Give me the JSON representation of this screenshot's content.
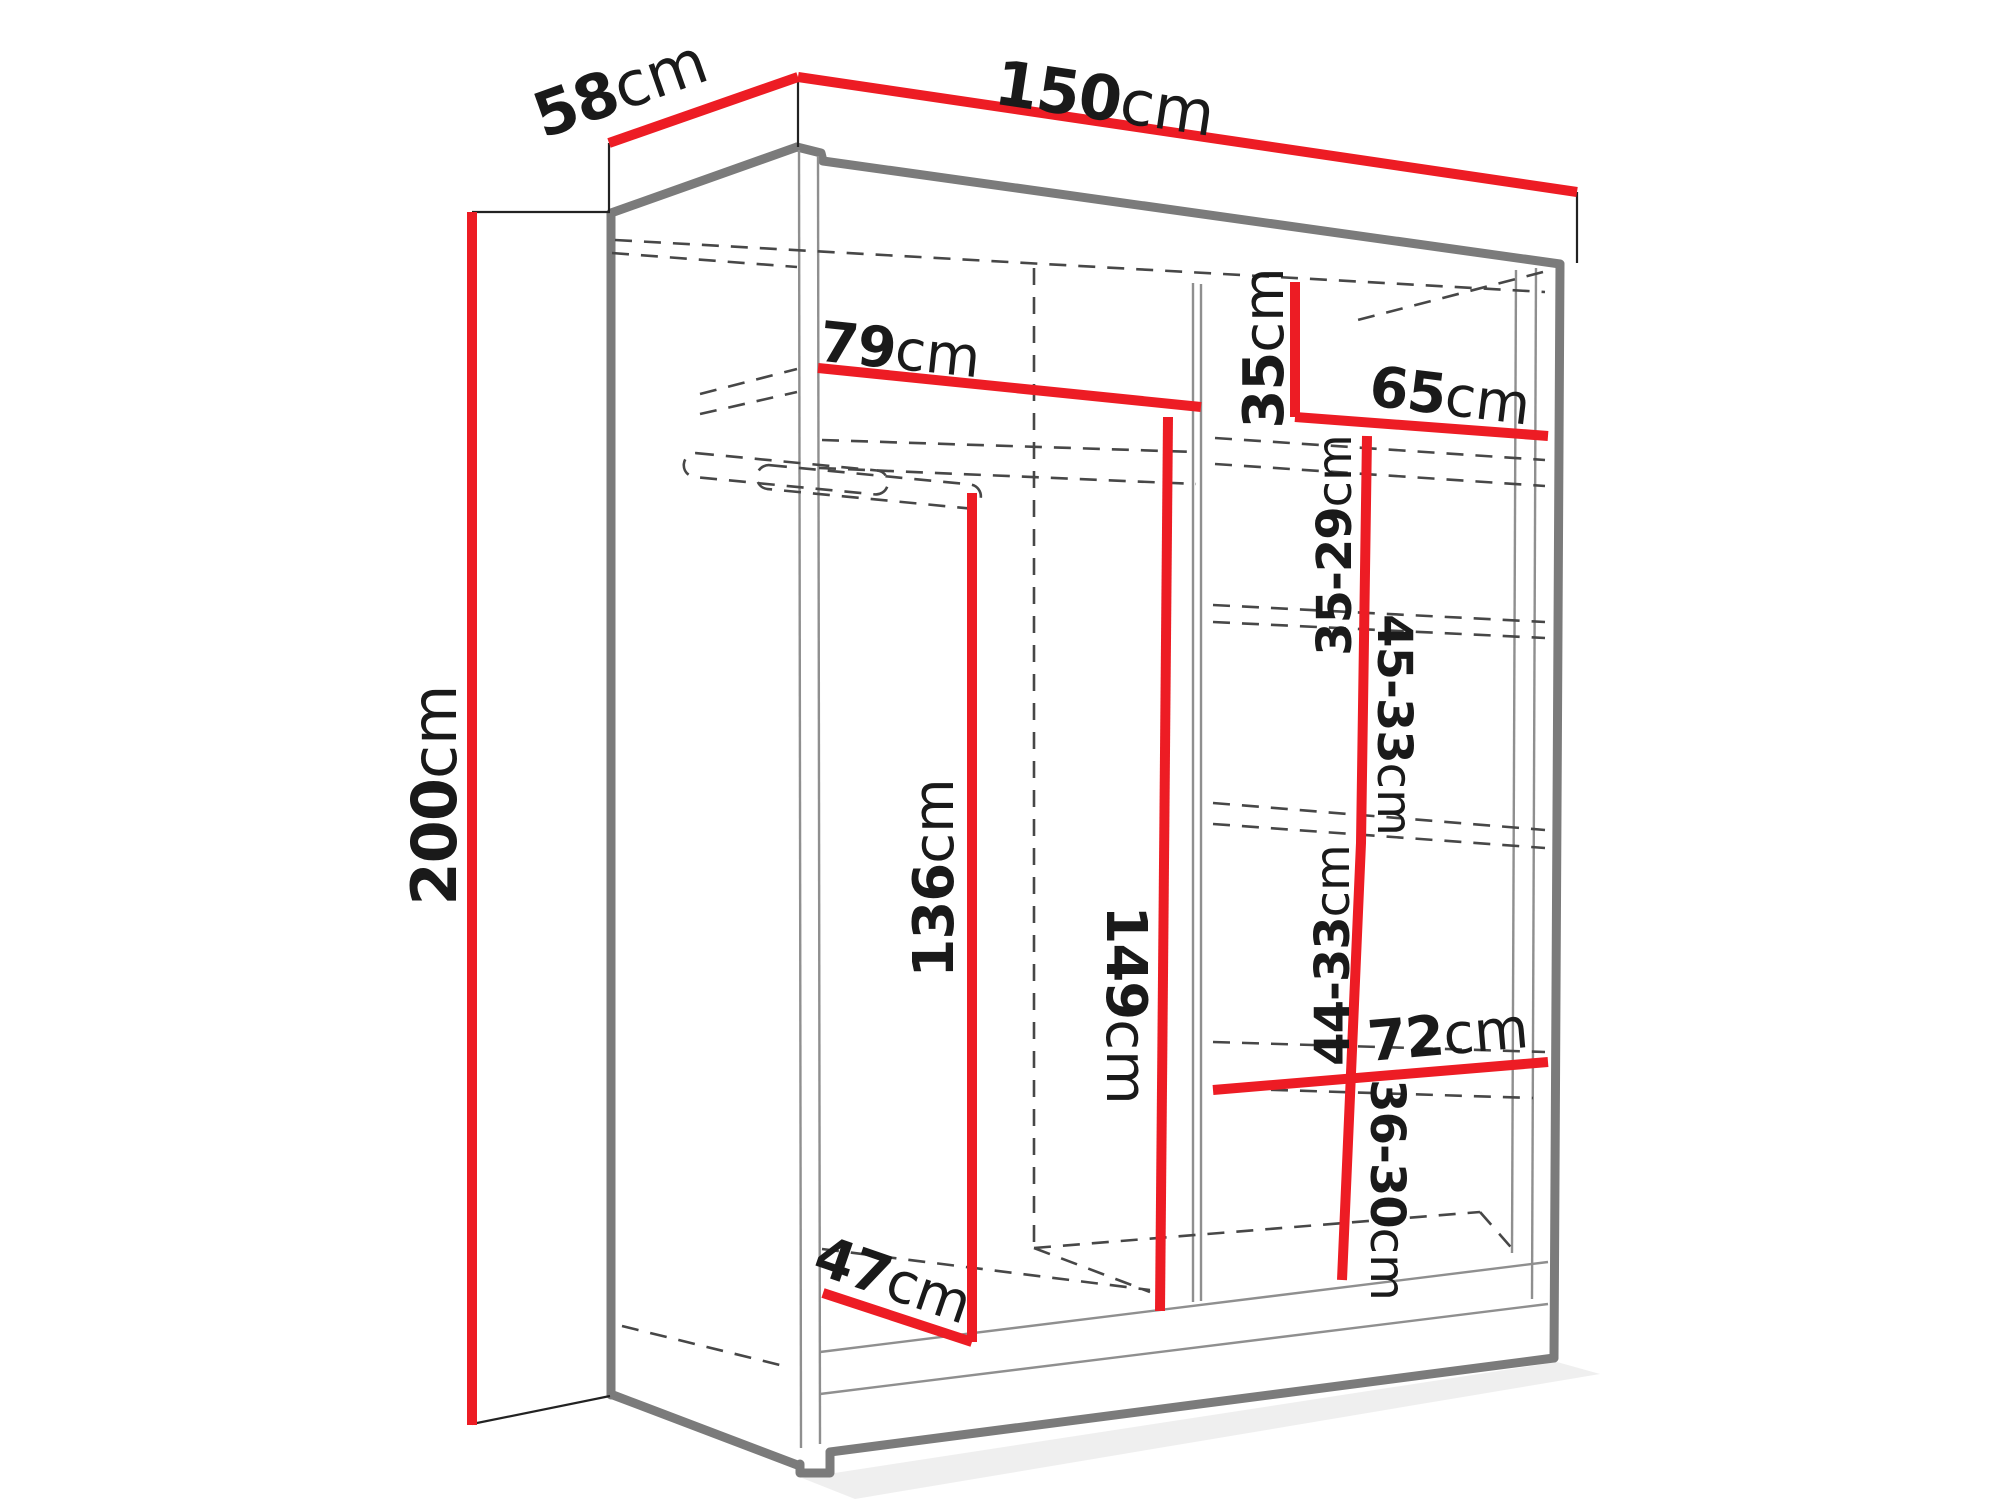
{
  "colors": {
    "dimension_line": "#ED1C24",
    "outline": "#7B7B7B",
    "hidden_edge": "#474747",
    "label_text": "#1A1A1A",
    "background": "#FFFFFF"
  },
  "dimensions": {
    "height": {
      "value": "200",
      "unit": "cm"
    },
    "width": {
      "value": "150",
      "unit": "cm"
    },
    "depth": {
      "value": "58",
      "unit": "cm"
    },
    "left_section_width": {
      "value": "79",
      "unit": "cm"
    },
    "top_shelf_height": {
      "value": "35",
      "unit": "cm"
    },
    "right_section_width": {
      "value": "65",
      "unit": "cm"
    },
    "shelf_gap_1": {
      "value": "35-29",
      "unit": "cm"
    },
    "shelf_gap_2": {
      "value": "45-33",
      "unit": "cm"
    },
    "shelf_gap_3": {
      "value": "44-33",
      "unit": "cm"
    },
    "shelf_gap_4": {
      "value": "36-30",
      "unit": "cm"
    },
    "left_section_height": {
      "value": "136",
      "unit": "cm"
    },
    "middle_section_height": {
      "value": "149",
      "unit": "cm"
    },
    "bottom_right_shelf_width": {
      "value": "72",
      "unit": "cm"
    },
    "hanging_area_depth": {
      "value": "47",
      "unit": "cm"
    }
  }
}
